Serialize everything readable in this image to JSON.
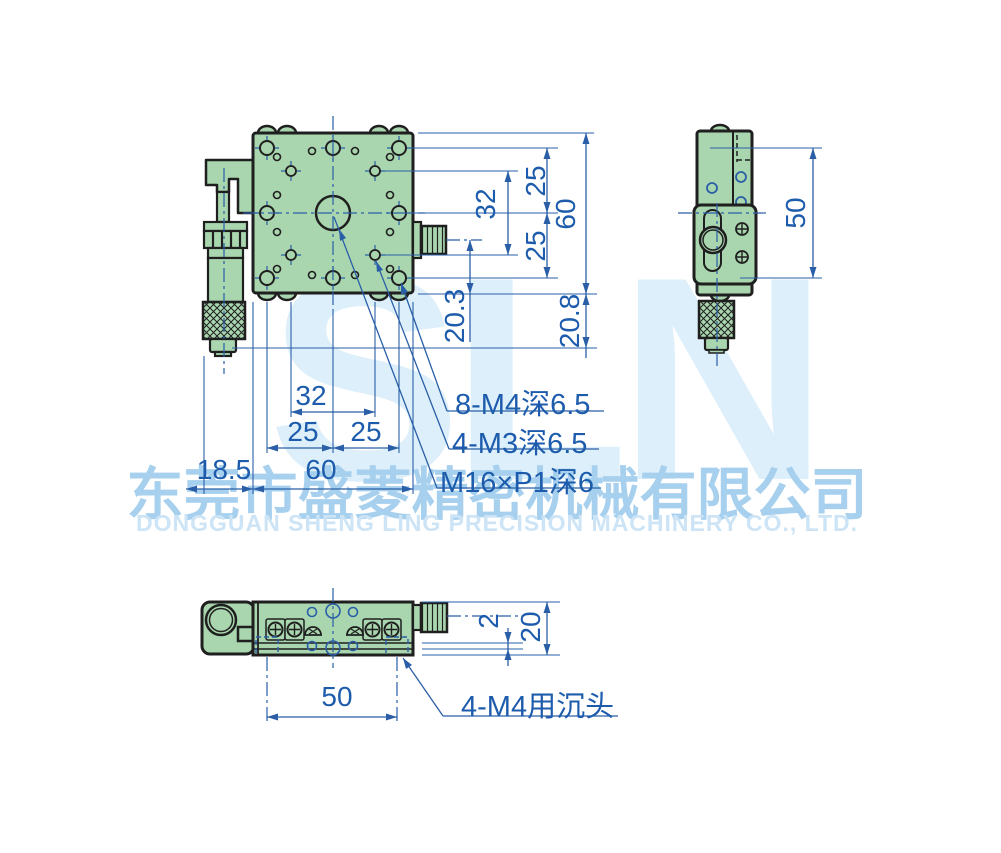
{
  "watermark": {
    "logo": "SLN",
    "company_cn": "东莞市盛菱精密机械有限公司",
    "company_en": "DONGGUAN SHENG LING PRECISION MACHINERY CO., LTD."
  },
  "front_view": {
    "vertical_dims": {
      "d25_top": "25",
      "d32": "32",
      "d25_bottom": "25",
      "d60": "60",
      "d20_3": "20.3",
      "d20_8": "20.8"
    },
    "horizontal_dims": {
      "d32": "32",
      "d25_left": "25",
      "d25_right": "25",
      "d18_5": "18.5",
      "d60": "60"
    },
    "callouts": {
      "thread_m4": "8-M4深6.5",
      "thread_m3": "4-M3深6.5",
      "thread_m16": "M16×P1深6"
    }
  },
  "side_view": {
    "dims": {
      "d50": "50"
    }
  },
  "bottom_view": {
    "dims": {
      "d50": "50",
      "d2": "2",
      "d20": "20"
    },
    "callouts": {
      "counterbore": "4-M4用沉头"
    }
  },
  "colors": {
    "body_green": "#a9d6ae",
    "outline_dark": "#1f1f1f",
    "line_blue": "#2a5fa8",
    "text_blue": "#1d5cac",
    "watermark_logo": "#ddeffa",
    "watermark_cn": "#a6d0ee",
    "watermark_en": "#cce4f5"
  }
}
